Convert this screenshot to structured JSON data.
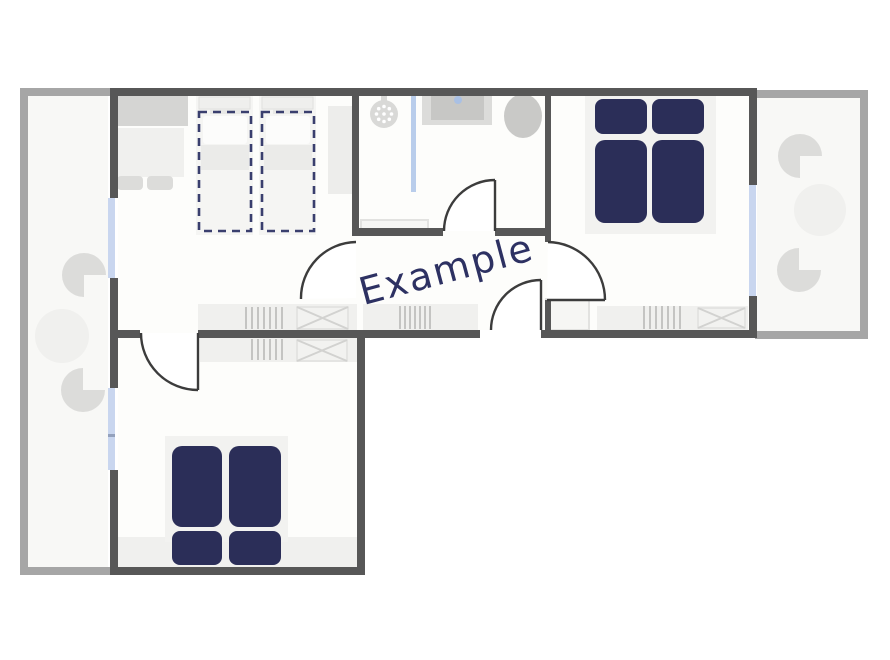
{
  "label": {
    "text": "Example"
  },
  "colors": {
    "wall": "#575757",
    "balcony_border": "#a6a6a6",
    "window": "#c9d6ef",
    "bed": "#2b2e58",
    "bed_outline": "#3a3f6e",
    "label_text": "#2d3162",
    "door_stroke": "#3c3c3c"
  }
}
